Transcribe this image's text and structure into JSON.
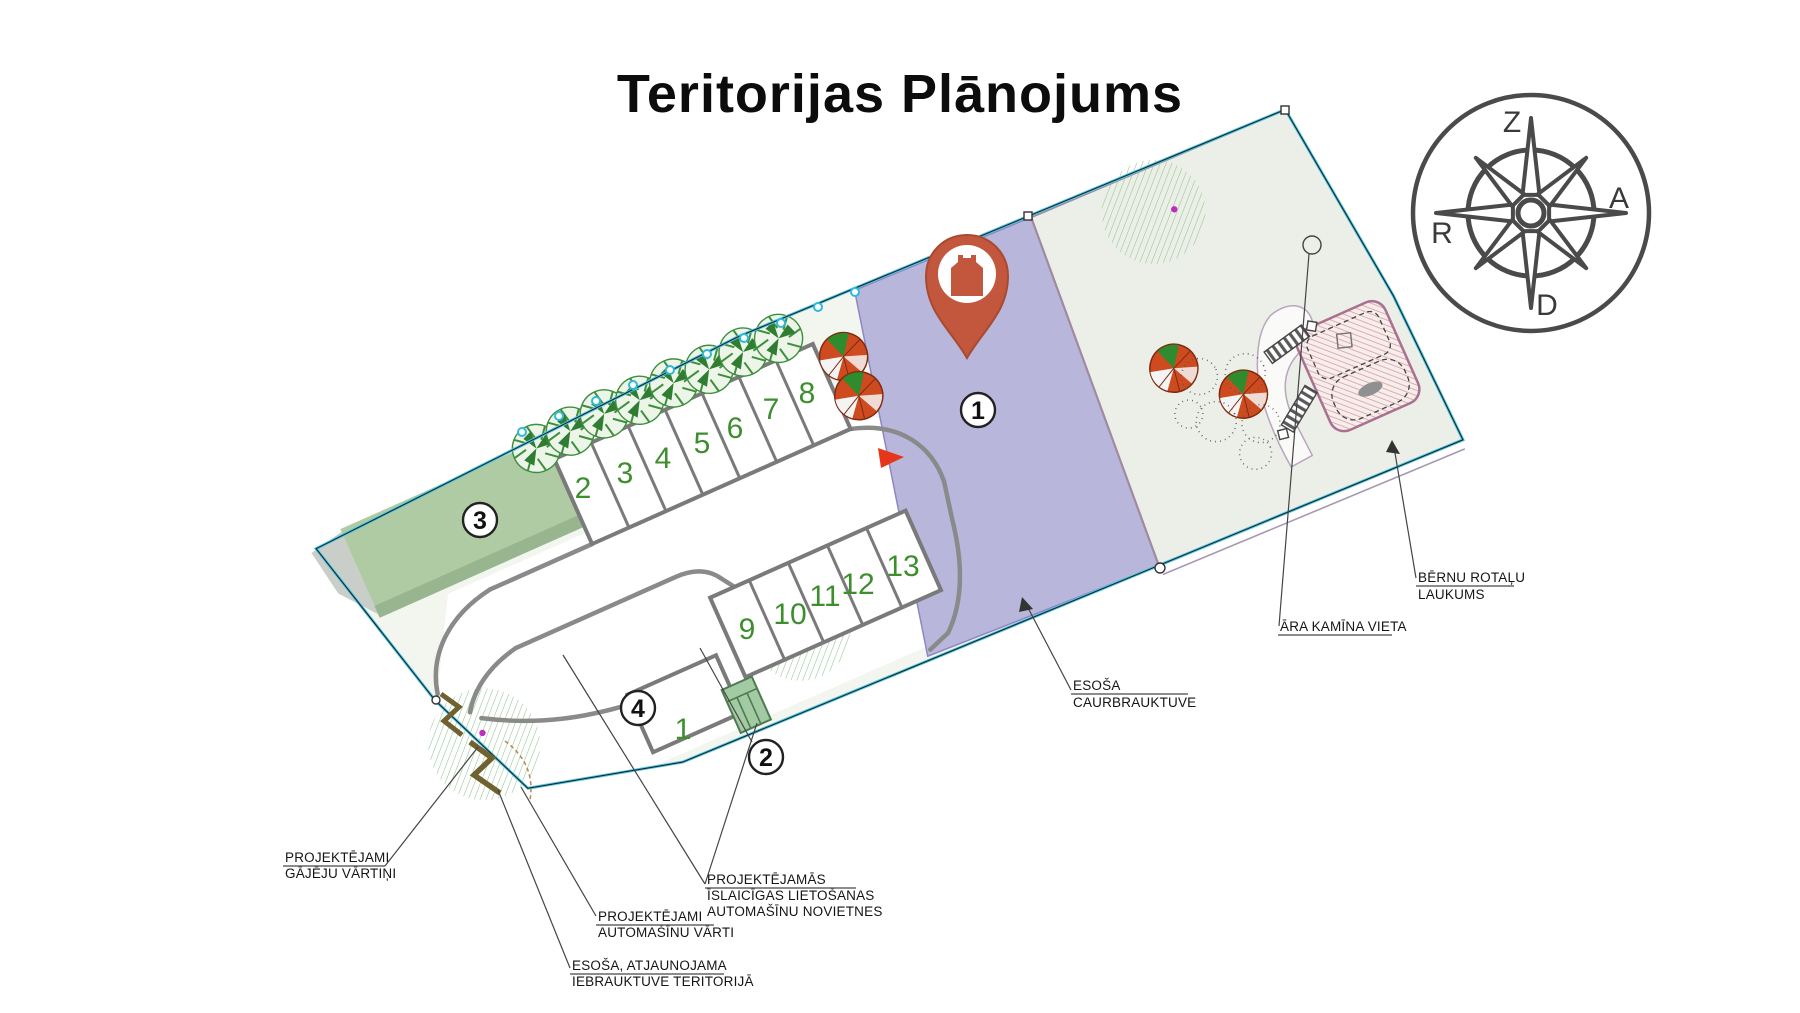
{
  "title": "Teritorijas Plānojums",
  "compass": {
    "north": "Z",
    "east": "A",
    "south": "D",
    "west": "R"
  },
  "markers": {
    "m1": "1",
    "m2": "2",
    "m3": "3",
    "m4": "4"
  },
  "stalls": {
    "row_a": [
      "2",
      "3",
      "4",
      "5",
      "6",
      "7",
      "8"
    ],
    "row_b": [
      "9",
      "10",
      "11",
      "12",
      "13"
    ],
    "large_stall": "1"
  },
  "labels": {
    "pedestrian_gate": [
      "PROJEKTĒJAMI",
      "GĀJĒJU VĀRTIŅI"
    ],
    "vehicle_gate": [
      "PROJEKTĒJAMI",
      "AUTOMAŠĪNU VĀRTI"
    ],
    "entrance": [
      "ESOŠA, ATJAUNOJAMA",
      "IEBRAUKTUVE TERITORIJĀ"
    ],
    "temporary_parking": [
      "PROJEKTĒJAMĀS",
      "ĪSLAICĪGAS LIETOŠANAS",
      "AUTOMAŠĪNU NOVIETNES"
    ],
    "through_drive": [
      "ESOŠA",
      "CAURBRAUKTUVE"
    ],
    "outdoor_fireplace": "ĀRA KAMĪNA VIETA",
    "playground": [
      "BĒRNU ROTAĻU",
      "LAUKUMS"
    ]
  },
  "colors": {
    "pin": "#C2573D",
    "through_drive_fill": "#B9B6DC",
    "boundary_cyan": "#49C8E8",
    "field_green": "#AECBA4",
    "stall_number_green": "#3E8E2E",
    "playground_hatch": "#D49A9A"
  }
}
